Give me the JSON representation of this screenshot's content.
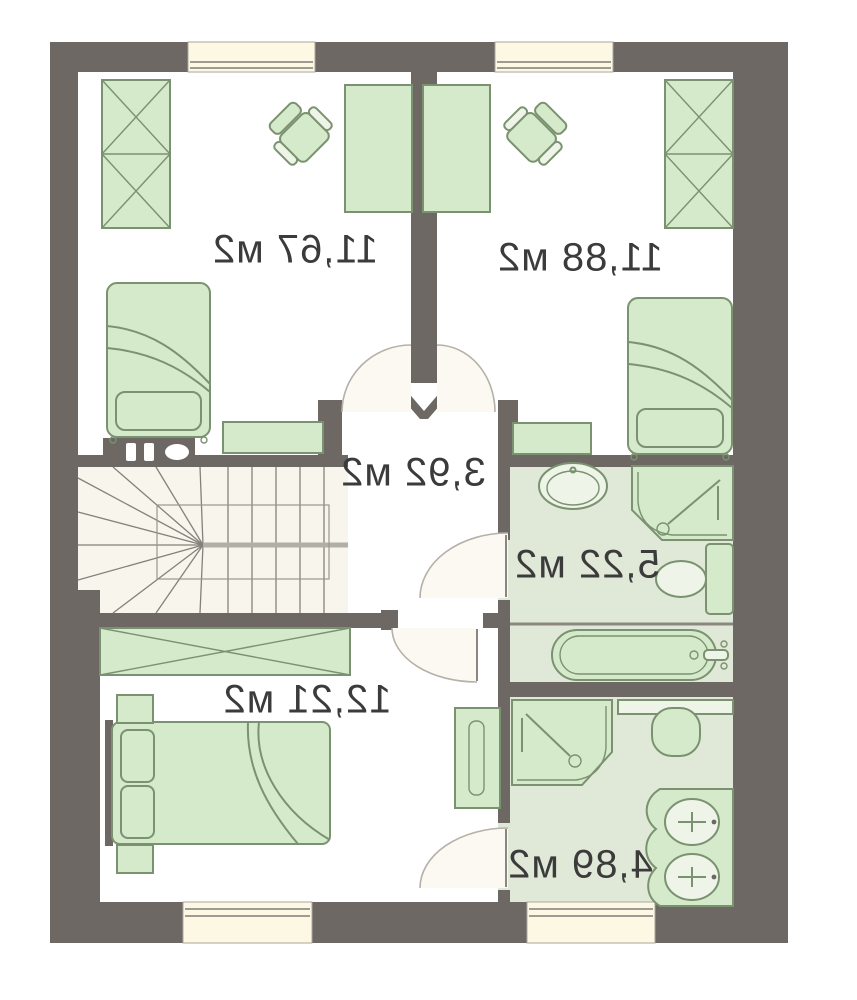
{
  "plan": {
    "rooms": [
      {
        "name": "bedroom-top-left",
        "area_label": "11,67 м2"
      },
      {
        "name": "bedroom-top-right",
        "area_label": "11,88 м2"
      },
      {
        "name": "hall",
        "area_label": "3,92 м2"
      },
      {
        "name": "bathroom-upper",
        "area_label": "5,22 м2"
      },
      {
        "name": "bedroom-bottom",
        "area_label": "12,21 м2"
      },
      {
        "name": "bathroom-lower",
        "area_label": "4,89 м2"
      }
    ],
    "colors": {
      "wall": "#6d6863",
      "furniture_fill": "#d5e9cb",
      "furniture_stroke": "#7a926f",
      "bath_floor": "#e0e9d8",
      "stair_floor": "#f8f5ec",
      "window_fill": "#fcf8e4",
      "door_arc": "#b5b1a8",
      "swing_fill": "#fbf9f1",
      "label_text": "#3b3b3b",
      "background": "#ffffff"
    }
  }
}
